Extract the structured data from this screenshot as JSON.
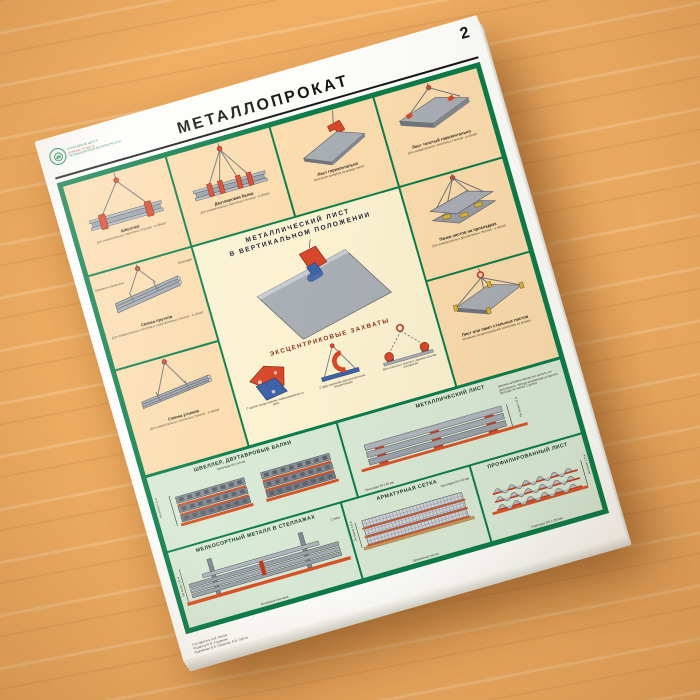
{
  "colors": {
    "frame_green": "#0b7c49",
    "panel_peach": "#fbdcae",
    "center_cream": "#fbf2d2",
    "storage_mint": "#d8e9d5",
    "spacer_orange": "#d85327",
    "grip_red": "#d9472b",
    "grip_blue": "#3f63a8",
    "metal_gray": "#9aa1a9"
  },
  "header": {
    "title": "МЕТАЛЛОПРОКАТ",
    "page_number": "2",
    "logo_lines": [
      "ОТРАСЛЕВОЙ ЦЕНТР",
      "ОХРАНЫ ТРУДА И",
      "ПРОМЫШЛЕННОЙ БЕЗОПАСНОСТИ"
    ]
  },
  "panels": {
    "p1": {
      "caption": "Швеллер",
      "note": "Для универсальных ленточных стропов - в обхват"
    },
    "p2": {
      "caption": "Двутавровая балка",
      "note": "Для универсальных ленточных стропов - в обхват"
    },
    "p3": {
      "caption": "Лист горизонтально",
      "note": "Листовым захватом за кромку листа"
    },
    "p4": {
      "caption": "Лист толстый горизонтально",
      "note": "Для универсальных ленточных стропов - в обхват"
    },
    "p5": {
      "caption": "Пачка листов на прокладках",
      "note": "Для универсальных двухветвевых стропов - в обхват"
    },
    "p6": {
      "caption": "Лист или пакет стальных листов",
      "note": "Четырьмя эксцентриковыми захватами за кромки"
    },
    "p7": {
      "caption": "Связка прутков",
      "note": "Для универсальных ленточных и двухветвевых стропов - в обхват",
      "label_wire": "Обвязка из проволоки",
      "label_spacer": "Прокладки"
    },
    "p8": {
      "caption": "Связка уголков",
      "note": "Для универсальных ленточных стропов - в обхват"
    }
  },
  "center": {
    "heading": "МЕТАЛЛИЧЕСКИЙ ЛИСТ\nВ ВЕРТИКАЛЬНОМ ПОЛОЖЕНИИ",
    "grips_title": "ЭКСЦЕНТРИКОВЫЕ ЗАХВАТЫ",
    "grips": [
      {
        "caption": "С одним эксцентриком, навешиваемым на крюк"
      },
      {
        "caption": "С двусторонним дополнительным эксцентриком"
      },
      {
        "caption": "Для стальных листов в горизонтальном положении"
      }
    ]
  },
  "storage": {
    "shveller": {
      "title": "ШВЕЛЛЕР, ДВУТАВРОВЫЕ БАЛКИ",
      "spacer_label": "Прокладки 80 х 80 мм",
      "height_label": "Не более 1,5 м"
    },
    "metlist": {
      "title": "МЕТАЛЛИЧЕСКИЙ ЛИСТ",
      "spacer_label": "Прокладки 80 х 80 мм",
      "height_label": "Не более 1,5 м",
      "note": "Ширина штабеля менее его высоты не допускается. Между штабелями оставлять проходы не менее 1 метра"
    },
    "melkosort": {
      "title": "МЕЛКОСОРТНЫЙ МЕТАЛЛ В СТЕЛЛАЖАХ",
      "base_label": "Основание стеллажа",
      "post_label": "Стойка",
      "height_label": "Не более 1,5 м"
    },
    "armsetka": {
      "title": "АРМАТУРНАЯ СЕТКА",
      "deck_label": "Деревянный настил",
      "spacer_label": "Прокладки 80 х 80 мм",
      "height_label": "Не более 1,5 м"
    },
    "proflist": {
      "title": "ПРОФИЛИРОВАННЫЙ ЛИСТ",
      "spacer_label": "Подкладки 200 х 200 мм",
      "height_label": "Не более 1,5 м"
    }
  },
  "credits": [
    "Составитель А.В. Лысов",
    "Редактор Е.В. Гордеева",
    "Художники В.А. Смирнов, А.В. Орлов"
  ]
}
